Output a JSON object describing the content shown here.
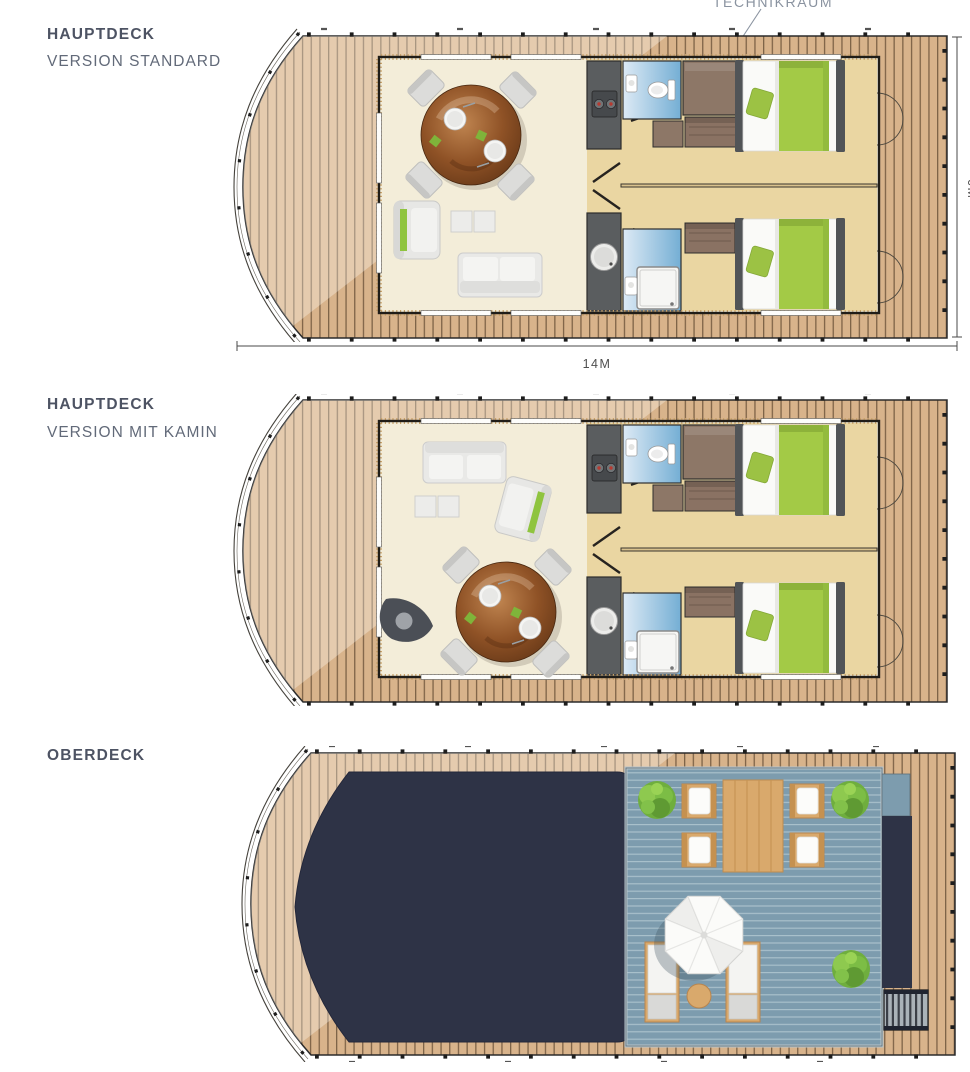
{
  "page": {
    "background": "#ffffff"
  },
  "sections": [
    {
      "id": "hauptdeck-standard",
      "title": "HAUPTDECK",
      "subtitle": "VERSION STANDARD"
    },
    {
      "id": "hauptdeck-kamin",
      "title": "HAUPTDECK",
      "subtitle": "VERSION MIT KAMIN"
    },
    {
      "id": "oberdeck",
      "title": "OBERDECK",
      "subtitle": ""
    }
  ],
  "annotations": {
    "technikraum": "TECHNIKRAUM",
    "length_dimension": "14M",
    "width_dimension": "6M"
  },
  "palette": {
    "label_title": "#4d5363",
    "label_subtitle": "#626a79",
    "annotation_gray": "#8a93a0",
    "deck_wood": "#d8b38b",
    "plank_line": "#7e6347",
    "living_floor": "#f3edd9",
    "bedroom_floor": "#ead6a2",
    "bathroom_blue": "#74aed4",
    "kitchen_gray": "#5a5d5f",
    "technikraum_brown": "#8d7767",
    "bed_green": "#a3ca46",
    "roof_navy": "#2e3346",
    "terrace_blue": "#7d9cae",
    "terrace_wood": "#d9a96c",
    "bush_green": "#6fae3e"
  }
}
